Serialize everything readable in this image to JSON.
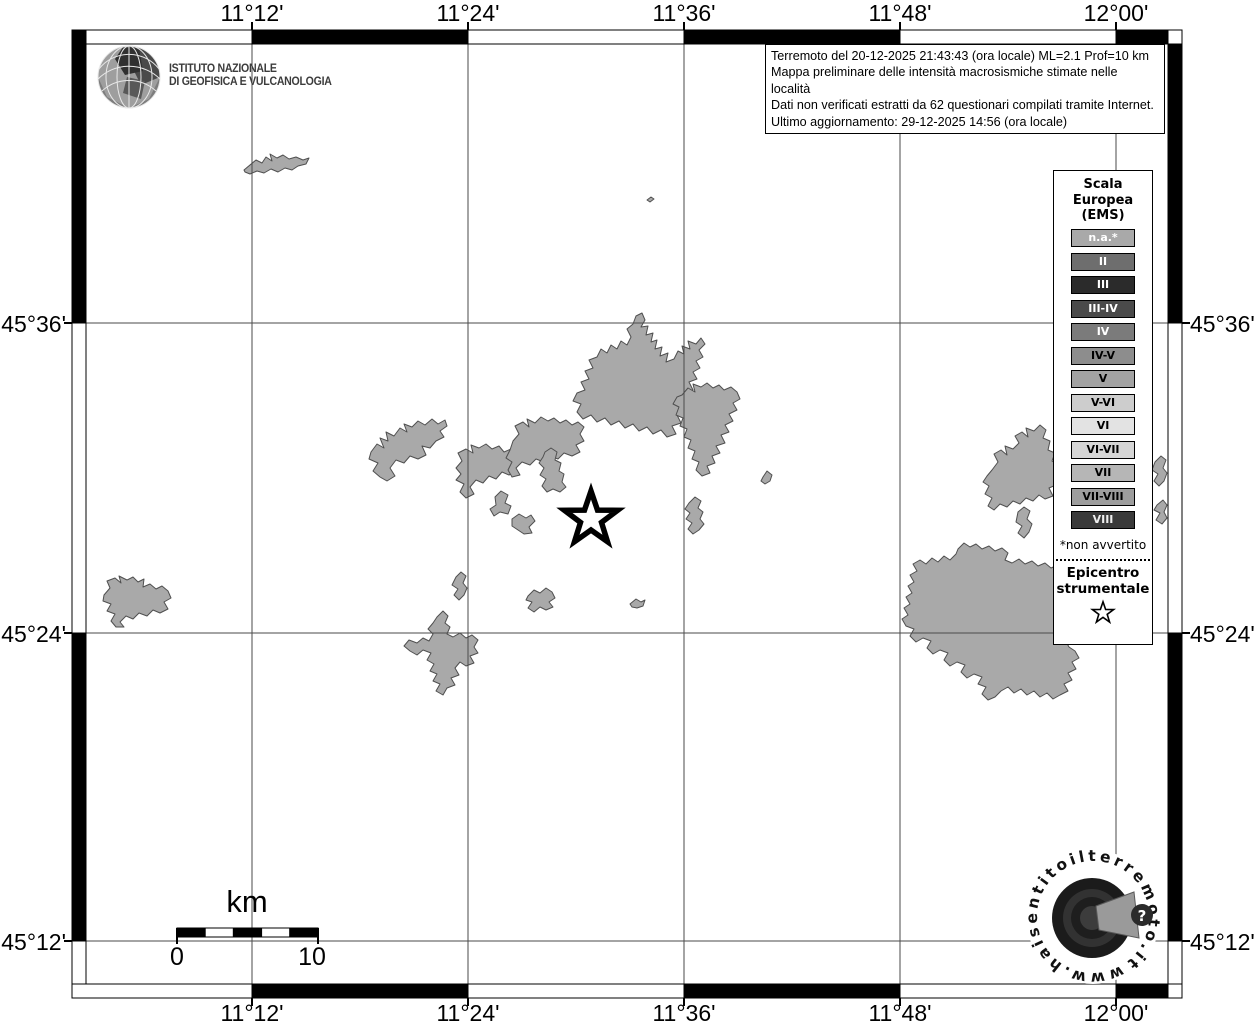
{
  "title_block": {
    "line1": "Terremoto del 20-12-2025 21:43:43 (ora locale) ML=2.1 Prof=10 km",
    "line2": "Mappa preliminare delle intensità macrosismiche stimate nelle località",
    "line3": "Dati non verificati estratti da 62 questionari compilati tramite Internet.",
    "line4": "Ultimo aggiornamento: 29-12-2025 14:56 (ora locale)"
  },
  "logo_ingv": {
    "line1": "ISTITUTO NAZIONALE",
    "line2": "DI GEOFISICA E VULCANOLOGIA"
  },
  "axes": {
    "lon": [
      "11°12'",
      "11°24'",
      "11°36'",
      "11°48'",
      "12°00'"
    ],
    "lat": [
      "45°36'",
      "45°24'",
      "45°12'"
    ]
  },
  "scale_bar": {
    "unit": "km",
    "start_label": "0",
    "end_label": "10"
  },
  "legend": {
    "title": [
      "Scala",
      "Europea",
      "(EMS)"
    ],
    "items": [
      {
        "label": "n.a.*",
        "bg": "#a9a9a9",
        "fg": "#ffffff"
      },
      {
        "label": "II",
        "bg": "#6e6e6e",
        "fg": "#ffffff"
      },
      {
        "label": "III",
        "bg": "#2b2b2b",
        "fg": "#ffffff"
      },
      {
        "label": "III-IV",
        "bg": "#4a4a4a",
        "fg": "#ffffff"
      },
      {
        "label": "IV",
        "bg": "#7b7b7b",
        "fg": "#ffffff"
      },
      {
        "label": "IV-V",
        "bg": "#8d8d8d",
        "fg": "#000000"
      },
      {
        "label": "V",
        "bg": "#a2a2a2",
        "fg": "#000000"
      },
      {
        "label": "V-VI",
        "bg": "#cdcdcd",
        "fg": "#000000"
      },
      {
        "label": "VI",
        "bg": "#e3e3e3",
        "fg": "#000000"
      },
      {
        "label": "VI-VII",
        "bg": "#d5d5d5",
        "fg": "#000000"
      },
      {
        "label": "VII",
        "bg": "#b6b6b6",
        "fg": "#000000"
      },
      {
        "label": "VII-VIII",
        "bg": "#9d9d9d",
        "fg": "#000000"
      },
      {
        "label": "VIII",
        "bg": "#3a3a3a",
        "fg": "#eeeeee"
      }
    ],
    "footnote": "*non avvertito",
    "epicenter_label_line1": "Epicentro",
    "epicenter_label_line2": "strumentale"
  },
  "watermark": {
    "text": "www.haisentitoilterremoto.it",
    "question_mark": "?"
  },
  "map_colors": {
    "land": "#a9a9a9",
    "land_edge": "#4f4f4f",
    "grid": "#4a4a4a"
  }
}
